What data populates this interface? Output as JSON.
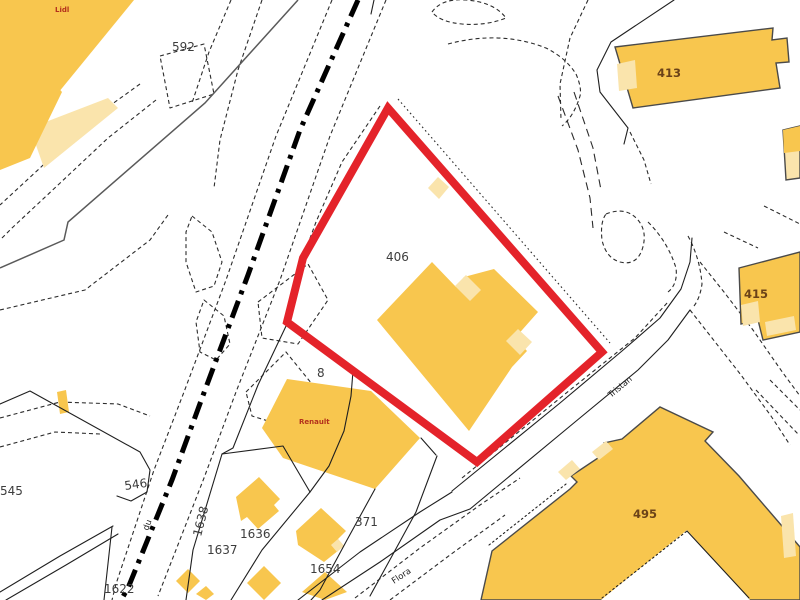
{
  "map": {
    "kind": "cadastral-map",
    "selected_parcel": {
      "number": "406",
      "outline_color": "#E4232A"
    },
    "colors": {
      "building_fill": "#F8C64E",
      "building_pale": "#FAE4AC",
      "selection_red": "#E4232A",
      "parcel_line": "#1F1F1F",
      "road_dash": "#2B2B2B",
      "railway": "#000000",
      "label_dark": "#3D3D3D",
      "label_on_building": "#6B4218",
      "business_label": "#B3301C"
    },
    "labels": {
      "parcels": {
        "p592": "592",
        "p545": "545",
        "p546": "546",
        "p406": "406",
        "p8": "8",
        "p371": "371",
        "p1636": "1636",
        "p1637": "1637",
        "p1638": "1638",
        "p1654": "1654",
        "p1622": "1622",
        "p413": "413",
        "p415": "415",
        "p495": "495"
      },
      "businesses": {
        "lidl": "Lidl",
        "renault": "Renault"
      },
      "streets": {
        "tristan": "Tristan",
        "flora": "Flora",
        "du": "du"
      }
    }
  }
}
